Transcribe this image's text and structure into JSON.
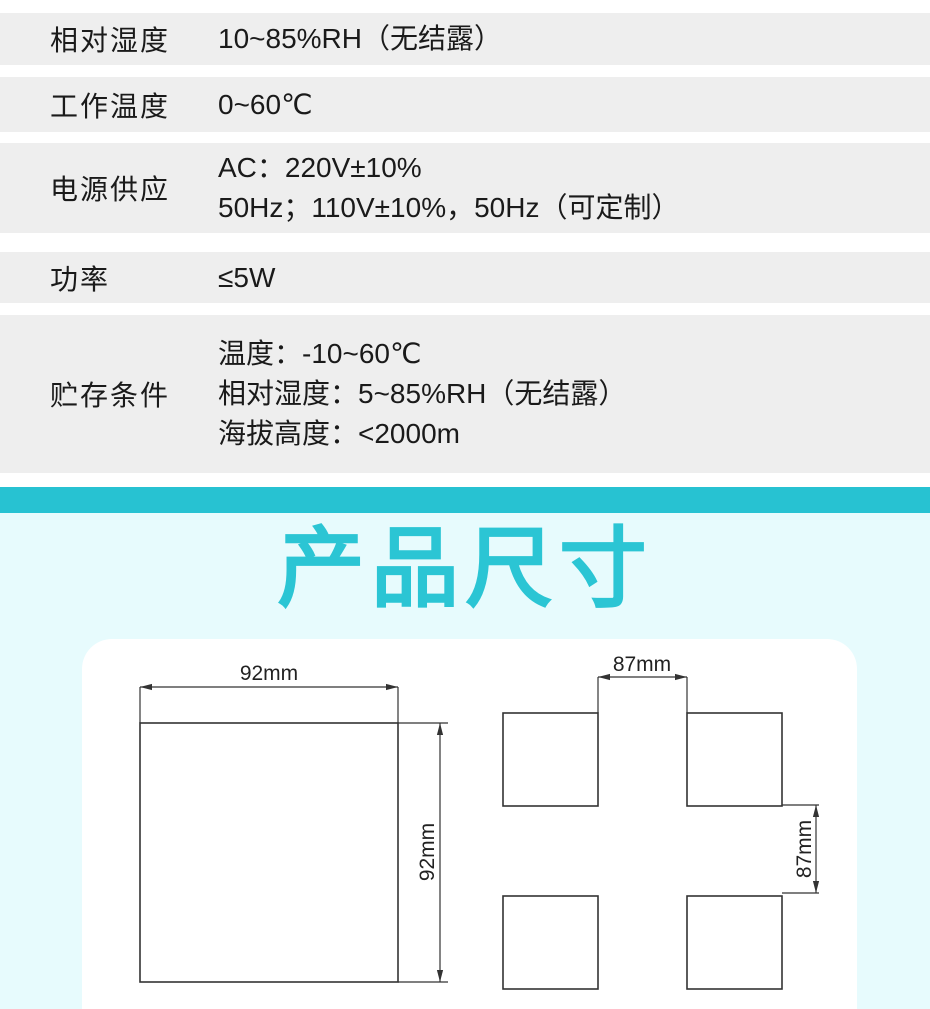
{
  "table": {
    "rows": [
      {
        "label": "相对湿度",
        "lines": [
          "10~85%RH（无结露）"
        ]
      },
      {
        "label": "工作温度",
        "lines": [
          "0~60℃"
        ]
      },
      {
        "label": "电源供应",
        "lines": [
          "AC：220V±10%",
          "50Hz；110V±10%，50Hz（可定制）"
        ]
      },
      {
        "label": "功率",
        "lines": [
          "≤5W"
        ]
      },
      {
        "label": "贮存条件",
        "lines": [
          "温度：-10~60℃",
          "相对湿度：5~85%RH（无结露）",
          "海拔高度：<2000m"
        ]
      }
    ]
  },
  "section": {
    "title": "产品尺寸"
  },
  "drawings": {
    "front": {
      "width_label": "92mm",
      "height_label": "92mm"
    },
    "cutout": {
      "width_label": "87mm",
      "height_label": "87mm"
    }
  },
  "colors": {
    "accent_bar": "#27C2D2",
    "title": "#2BC5D4",
    "section_bg": "#E7FBFD",
    "row_bg": "#EEEEEE",
    "text": "#1A1A1A",
    "drawing_line": "#333333"
  }
}
